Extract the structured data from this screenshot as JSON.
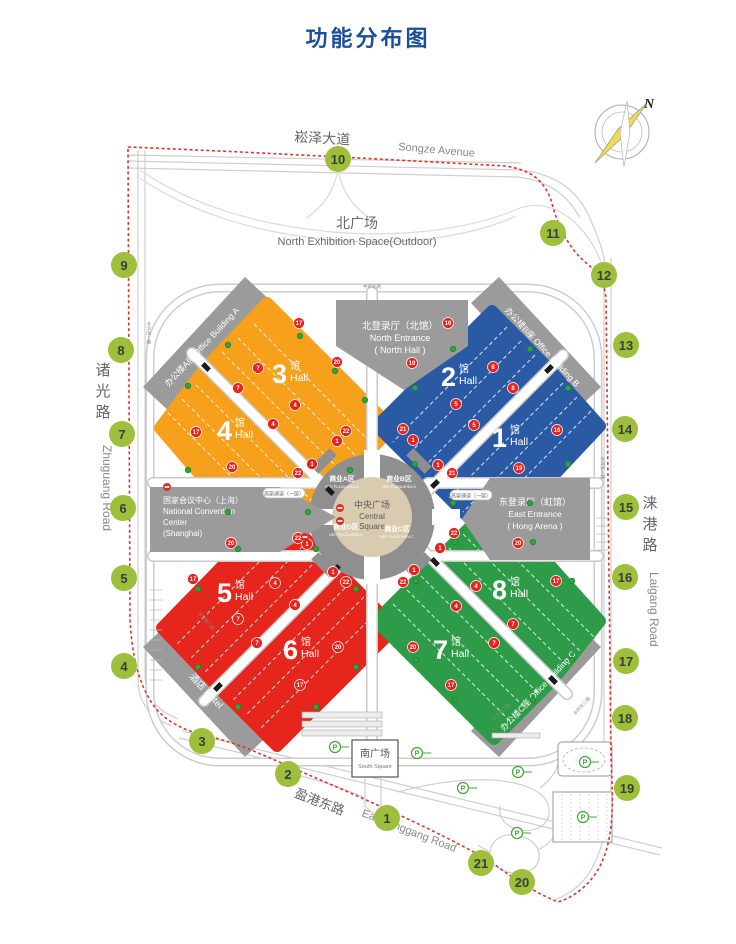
{
  "title": "功能分布图",
  "compass": {
    "label": "N"
  },
  "colors": {
    "title": "#1B4F9C",
    "orange": "#F6A01B",
    "blue": "#2B5AA5",
    "red": "#E6251C",
    "green": "#2E9B49",
    "building_gray": "#9B9B9B",
    "ring_gray": "#8F8F8F",
    "center_tan": "#D9CBB0",
    "boundary_red": "#E2342B",
    "marker_green": "#9DBF3B",
    "marker_text": "#3D3D3D",
    "gate_red": "#E8231D",
    "dot_green": "#2FA33C",
    "parking_green": "#3BA935"
  },
  "roads": {
    "songze_cn": "崧泽大道",
    "songze_en": "Songze Avenue",
    "zhuguang_cn": "诸光路",
    "zhuguang_en": "Zhuguang Road",
    "laigang_cn": "涞港路",
    "laigang_en": "Laigang Road",
    "yinggang_cn": "盈港东路",
    "yinggang_en": "East Yinggang Road",
    "viaduct_west": "高架通道（一层）",
    "viaduct_east": "高架通道（一层）"
  },
  "areas": {
    "north_square_cn": "北广场",
    "north_square_en": "North Exhibition Space(Outdoor)",
    "south_square_cn": "南广场",
    "south_square_en": "South Square",
    "central_cn": "中央广场",
    "central_en1": "Central",
    "central_en2": "Square"
  },
  "buildings": {
    "office_a": "办公楼A座  Office Building A",
    "office_b": "办公楼B座  Office Building B",
    "office_c": "办公楼C座  Office Building C",
    "hotel": "酒店  Hotel",
    "ncc1": "国家会议中心（上海）",
    "ncc2": "National Convention",
    "ncc3": "Center",
    "ncc4": "(Shanghai)",
    "north_ent1": "北登录厅（北馆）",
    "north_ent2": "North Entrance",
    "north_ent3": "( North Hall )",
    "east_ent1": "东登录厅（虹馆）",
    "east_ent2": "East Entrance",
    "east_ent3": "( Hong Arena )"
  },
  "hall_label": {
    "suffix": "馆",
    "en": "Hall"
  },
  "halls": [
    {
      "num": "3",
      "x": 283,
      "y": 383
    },
    {
      "num": "4",
      "x": 228,
      "y": 440
    },
    {
      "num": "2",
      "x": 452,
      "y": 386
    },
    {
      "num": "1",
      "x": 503,
      "y": 447
    },
    {
      "num": "5",
      "x": 228,
      "y": 602
    },
    {
      "num": "6",
      "x": 294,
      "y": 659
    },
    {
      "num": "8",
      "x": 503,
      "y": 599
    },
    {
      "num": "7",
      "x": 444,
      "y": 659
    }
  ],
  "plaza_quadrants": [
    {
      "cn": "商业A区",
      "en": "NEC PLAZA AREA A",
      "x": 342,
      "y": 481
    },
    {
      "cn": "商业B区",
      "en": "NEC PLAZA AREA B",
      "x": 399,
      "y": 481
    },
    {
      "cn": "商业D区",
      "en": "NEC PLAZA AREA D",
      "x": 346,
      "y": 529
    },
    {
      "cn": "商业C区",
      "en": "NEC PLAZA AREA C",
      "x": 397,
      "y": 531
    }
  ],
  "boundary_markers": [
    {
      "n": "1",
      "x": 387,
      "y": 818
    },
    {
      "n": "2",
      "x": 288,
      "y": 774
    },
    {
      "n": "3",
      "x": 202,
      "y": 741
    },
    {
      "n": "4",
      "x": 124,
      "y": 666
    },
    {
      "n": "5",
      "x": 124,
      "y": 578
    },
    {
      "n": "6",
      "x": 123,
      "y": 508
    },
    {
      "n": "7",
      "x": 122,
      "y": 434
    },
    {
      "n": "8",
      "x": 121,
      "y": 350
    },
    {
      "n": "9",
      "x": 124,
      "y": 265
    },
    {
      "n": "10",
      "x": 338,
      "y": 159
    },
    {
      "n": "11",
      "x": 553,
      "y": 233
    },
    {
      "n": "12",
      "x": 604,
      "y": 275
    },
    {
      "n": "13",
      "x": 626,
      "y": 345
    },
    {
      "n": "14",
      "x": 625,
      "y": 429
    },
    {
      "n": "15",
      "x": 626,
      "y": 507
    },
    {
      "n": "16",
      "x": 625,
      "y": 577
    },
    {
      "n": "17",
      "x": 626,
      "y": 661
    },
    {
      "n": "18",
      "x": 625,
      "y": 718
    },
    {
      "n": "19",
      "x": 627,
      "y": 788
    },
    {
      "n": "20",
      "x": 522,
      "y": 882
    },
    {
      "n": "21",
      "x": 481,
      "y": 863
    }
  ],
  "gate_markers": [
    [
      "17",
      299,
      323
    ],
    [
      "20",
      337,
      362
    ],
    [
      "7",
      258,
      368
    ],
    [
      "7",
      238,
      388
    ],
    [
      "4",
      295,
      405
    ],
    [
      "4",
      273,
      424
    ],
    [
      "17",
      196,
      432
    ],
    [
      "22",
      346,
      431
    ],
    [
      "1",
      337,
      441
    ],
    [
      "20",
      232,
      467
    ],
    [
      "1",
      312,
      464
    ],
    [
      "22",
      298,
      473
    ],
    [
      "16",
      448,
      323
    ],
    [
      "19",
      412,
      363
    ],
    [
      "8",
      493,
      367
    ],
    [
      "8",
      513,
      388
    ],
    [
      "5",
      456,
      404
    ],
    [
      "5",
      474,
      425
    ],
    [
      "21",
      403,
      429
    ],
    [
      "1",
      413,
      440
    ],
    [
      "16",
      557,
      430
    ],
    [
      "1",
      438,
      465
    ],
    [
      "21",
      452,
      473
    ],
    [
      "19",
      519,
      468
    ],
    [
      "20",
      231,
      543
    ],
    [
      "22",
      298,
      538
    ],
    [
      "1",
      307,
      544
    ],
    [
      "1",
      333,
      572
    ],
    [
      "17",
      193,
      579
    ],
    [
      "22",
      346,
      582
    ],
    [
      "4",
      275,
      583
    ],
    [
      "4",
      295,
      605
    ],
    [
      "7",
      238,
      619
    ],
    [
      "7",
      257,
      643
    ],
    [
      "20",
      338,
      647
    ],
    [
      "17",
      300,
      685
    ],
    [
      "22",
      454,
      533
    ],
    [
      "1",
      440,
      548
    ],
    [
      "20",
      518,
      543
    ],
    [
      "1",
      414,
      570
    ],
    [
      "22",
      403,
      582
    ],
    [
      "4",
      476,
      586
    ],
    [
      "17",
      556,
      581
    ],
    [
      "4",
      456,
      606
    ],
    [
      "7",
      513,
      624
    ],
    [
      "7",
      494,
      643
    ],
    [
      "20",
      413,
      647
    ],
    [
      "17",
      451,
      685
    ]
  ],
  "decor": {
    "green_dots": [
      [
        300,
        336
      ],
      [
        335,
        371
      ],
      [
        365,
        400
      ],
      [
        228,
        345
      ],
      [
        188,
        386
      ],
      [
        188,
        470
      ],
      [
        228,
        512
      ],
      [
        308,
        512
      ],
      [
        350,
        470
      ],
      [
        453,
        349
      ],
      [
        415,
        388
      ],
      [
        530,
        349
      ],
      [
        568,
        388
      ],
      [
        568,
        464
      ],
      [
        530,
        503
      ],
      [
        453,
        503
      ],
      [
        415,
        464
      ],
      [
        238,
        549
      ],
      [
        198,
        589
      ],
      [
        316,
        549
      ],
      [
        356,
        589
      ],
      [
        356,
        667
      ],
      [
        316,
        707
      ],
      [
        238,
        707
      ],
      [
        198,
        667
      ],
      [
        455,
        542
      ],
      [
        416,
        581
      ],
      [
        533,
        542
      ],
      [
        572,
        581
      ],
      [
        572,
        660
      ],
      [
        533,
        700
      ],
      [
        455,
        700
      ],
      [
        416,
        660
      ]
    ],
    "black_ticks": [
      [
        206,
        367,
        45
      ],
      [
        330,
        491,
        45
      ],
      [
        549,
        369,
        -45
      ],
      [
        435,
        484,
        -45
      ],
      [
        336,
        569,
        -45
      ],
      [
        218,
        687,
        -45
      ],
      [
        435,
        562,
        45
      ],
      [
        553,
        680,
        45
      ]
    ],
    "p_icons": [
      [
        335,
        747
      ],
      [
        417,
        753
      ],
      [
        463,
        788
      ],
      [
        518,
        772
      ],
      [
        517,
        833
      ],
      [
        585,
        762
      ],
      [
        583,
        817
      ]
    ],
    "no_entry": [
      [
        167,
        487
      ],
      [
        305,
        537
      ],
      [
        340,
        508
      ],
      [
        340,
        521
      ]
    ],
    "stripes": [
      [
        222,
        352,
        342,
        472
      ],
      [
        238,
        338,
        356,
        456
      ],
      [
        254,
        324,
        368,
        440
      ],
      [
        196,
        385,
        312,
        501
      ],
      [
        182,
        399,
        298,
        515
      ],
      [
        168,
        413,
        284,
        529
      ],
      [
        535,
        355,
        421,
        470
      ],
      [
        521,
        341,
        407,
        456
      ],
      [
        507,
        327,
        393,
        442
      ],
      [
        563,
        383,
        449,
        498
      ],
      [
        577,
        397,
        463,
        512
      ],
      [
        591,
        411,
        477,
        526
      ],
      [
        322,
        555,
        204,
        673
      ],
      [
        308,
        541,
        190,
        659
      ],
      [
        294,
        527,
        176,
        645
      ],
      [
        350,
        583,
        232,
        701
      ],
      [
        364,
        597,
        246,
        715
      ],
      [
        378,
        611,
        260,
        729
      ],
      [
        449,
        548,
        567,
        666
      ],
      [
        463,
        534,
        581,
        652
      ],
      [
        477,
        520,
        595,
        638
      ],
      [
        421,
        576,
        539,
        694
      ],
      [
        407,
        590,
        525,
        708
      ],
      [
        393,
        604,
        511,
        722
      ]
    ],
    "micro_roads": [
      {
        "t": "中环北路",
        "x": 372,
        "y": 288,
        "r": 0
      },
      {
        "t": "中环西一路",
        "x": 147,
        "y": 333,
        "r": 90
      },
      {
        "t": "中环东一路",
        "x": 601,
        "y": 468,
        "r": 90
      },
      {
        "t": "中环东三路",
        "x": 583,
        "y": 707,
        "r": -48
      },
      {
        "t": "中环西二路",
        "x": 205,
        "y": 622,
        "r": 48
      },
      {
        "t": "中环南二路",
        "x": 502,
        "y": 713,
        "r": -45
      }
    ]
  }
}
